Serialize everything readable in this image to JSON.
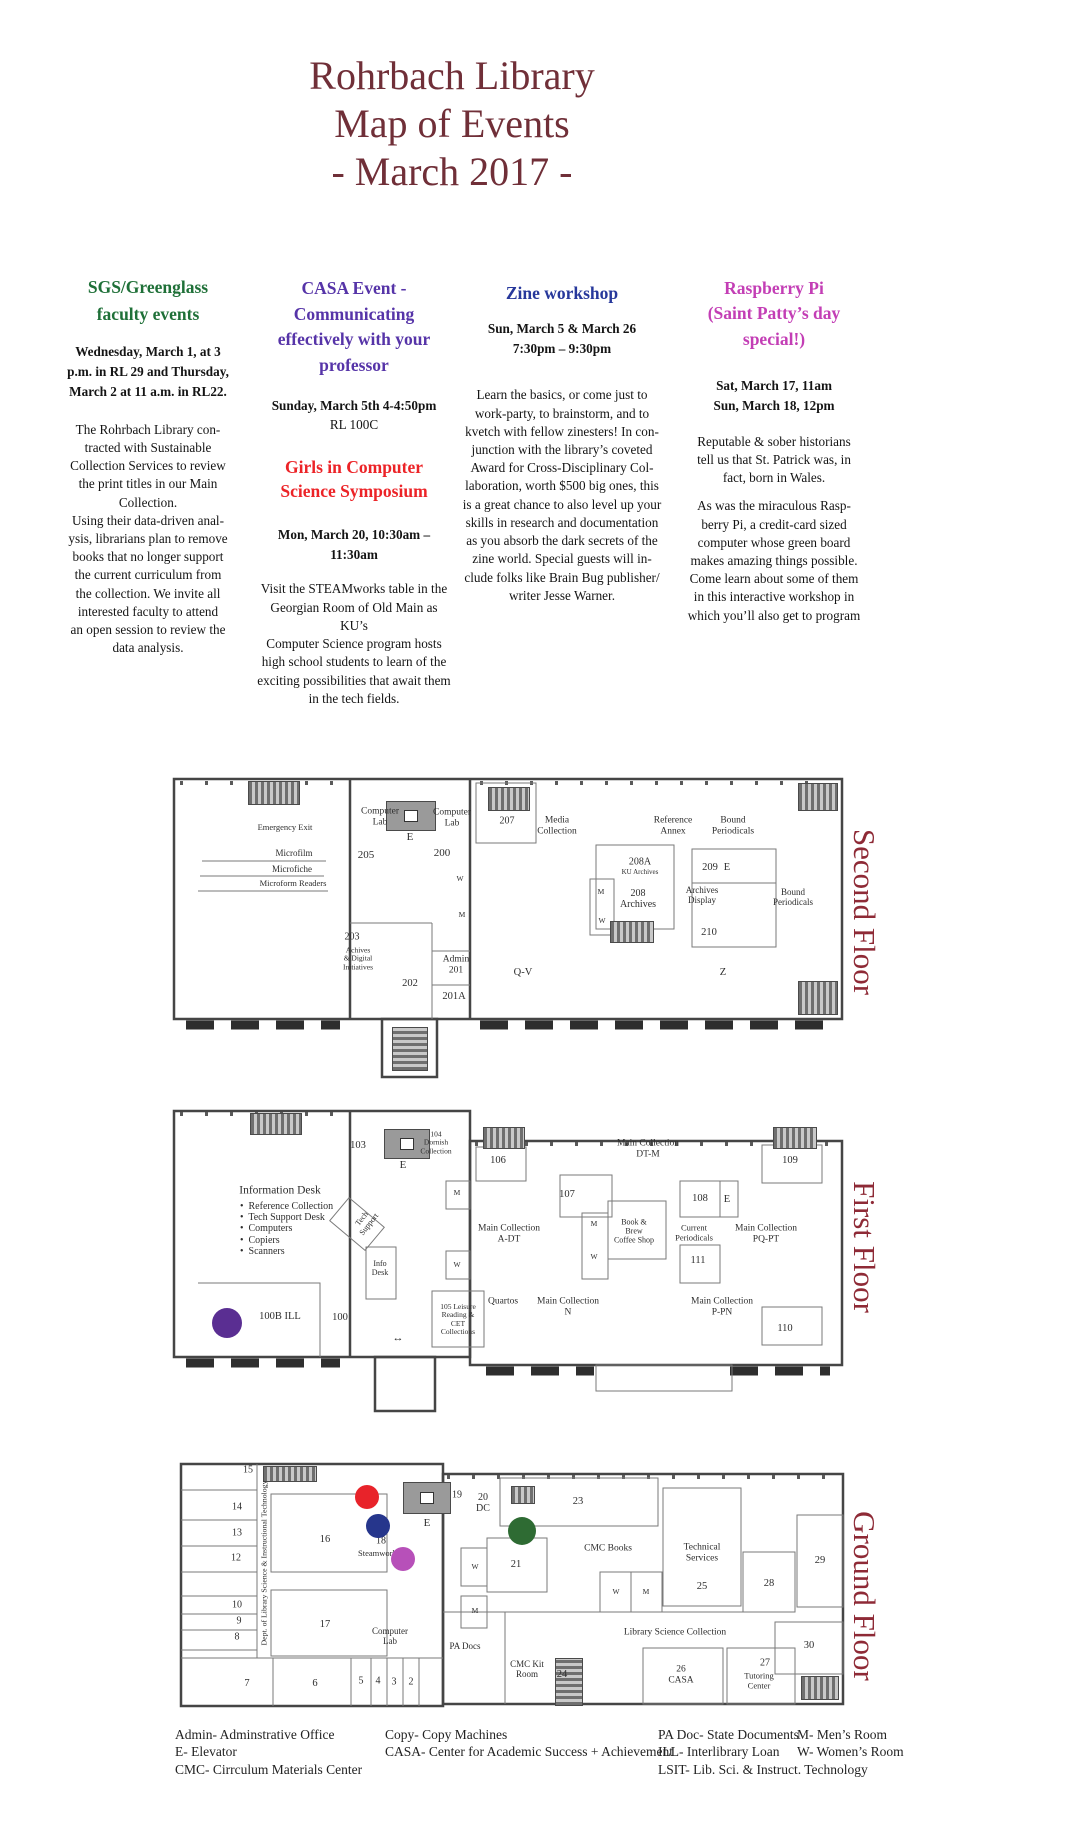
{
  "title_lines": [
    "Rohrbach Library",
    "Map of Events",
    "- March 2017 -"
  ],
  "colors": {
    "title_maroon": "#702f38",
    "floor_label_maroon": "#8e2a36",
    "sgs_green": "#1f7038",
    "casa_purple": "#5634a8",
    "girls_red": "#ec2327",
    "zine_blue": "#27389b",
    "raspberry_magenta": "#c33eb5",
    "marker_purple": "#5a2e92",
    "marker_red": "#e8232a",
    "marker_blue": "#26368c",
    "marker_orchid": "#b750b9",
    "marker_green": "#2e6b33"
  },
  "events": {
    "sgs": {
      "heading_lines": [
        "SGS/Greenglass",
        "faculty events"
      ],
      "when_lines": [
        "Wednesday, March 1, at 3",
        "p.m. in RL 29 and Thursday,",
        "March 2 at 11 a.m. in RL22."
      ],
      "body_lines": [
        "The Rohrbach Library con-",
        "tracted with Sustainable",
        "Collection Services to review",
        "the print titles in our Main",
        "Collection.",
        "Using their data-driven anal-",
        "ysis, librarians plan to remove",
        "books that no longer support",
        "the current curriculum from",
        "the collection. We invite all",
        "interested faculty to attend",
        "an open session to review the",
        "data analysis."
      ]
    },
    "casa": {
      "heading_lines": [
        "CASA Event -",
        "Communicating",
        "effectively with your",
        "professor"
      ],
      "when_bold": "Sunday, March 5th 4-4:50pm",
      "when_room": "RL 100C"
    },
    "girls": {
      "heading_lines": [
        "Girls in Computer",
        "Science Symposium"
      ],
      "when_lines": [
        "Mon, March 20, 10:30am –",
        "11:30am"
      ],
      "body_lines": [
        "Visit the STEAMworks table in the",
        "Georgian Room of Old Main as KU’s",
        "Computer Science program hosts",
        "high school students to learn of the",
        "exciting possibilities that await them",
        "in the tech fields."
      ]
    },
    "zine": {
      "heading": "Zine workshop",
      "when_lines": [
        "Sun, March 5 & March 26",
        "7:30pm – 9:30pm"
      ],
      "body_lines": [
        "Learn the basics, or come just to",
        "work-party, to brainstorm, and to",
        "kvetch with fellow zinesters! In con-",
        "junction with the library’s coveted",
        "Award for Cross-Disciplinary Col-",
        "laboration, worth $500 big ones, this",
        "is a great chance to also level up your",
        "skills in research and documentation",
        "as you absorb the dark secrets of the",
        "zine world. Special guests will in-",
        "clude folks like Brain Bug publisher/",
        "writer Jesse Warner."
      ]
    },
    "raspberry": {
      "heading_lines": [
        "Raspberry Pi",
        "(Saint Patty’s day",
        "special!)"
      ],
      "when_lines": [
        "Sat, March 17, 11am",
        "Sun, March 18, 12pm"
      ],
      "body1_lines": [
        "Reputable & sober historians",
        "tell us that St. Patrick was, in",
        "fact, born in Wales."
      ],
      "body2_lines": [
        "As was the miraculous Rasp-",
        "berry Pi, a credit-card sized",
        "computer whose green board",
        "makes amazing things possible.",
        "Come learn about some of them",
        "in this interactive workshop in",
        "which you’ll also get to program"
      ]
    }
  },
  "floors": [
    {
      "name": "Second Floor",
      "labels": [
        {
          "t": "Emergency Exit",
          "x": 115,
          "y": 53,
          "s": 8.5
        },
        {
          "t": "Microfilm",
          "x": 124,
          "y": 78,
          "s": 9
        },
        {
          "t": "Microfiche",
          "x": 122,
          "y": 94,
          "s": 9
        },
        {
          "t": "Microform Readers",
          "x": 123,
          "y": 109,
          "s": 8.5
        },
        {
          "t": "Computer\nLab",
          "x": 210,
          "y": 42,
          "s": 9.5
        },
        {
          "t": "205",
          "x": 196,
          "y": 80,
          "s": 11
        },
        {
          "t": "E",
          "x": 240,
          "y": 62,
          "s": 11
        },
        {
          "t": "Computer\nLab",
          "x": 282,
          "y": 43,
          "s": 9.5
        },
        {
          "t": "200",
          "x": 272,
          "y": 78,
          "s": 11
        },
        {
          "t": "W",
          "x": 290,
          "y": 104,
          "s": 7.5
        },
        {
          "t": "M",
          "x": 292,
          "y": 140,
          "s": 7.5
        },
        {
          "t": "207",
          "x": 337,
          "y": 46,
          "s": 10
        },
        {
          "t": "Media\nCollection",
          "x": 387,
          "y": 51,
          "s": 9.5
        },
        {
          "t": "Reference\nAnnex",
          "x": 503,
          "y": 51,
          "s": 9.5
        },
        {
          "t": "Bound\nPeriodicals",
          "x": 563,
          "y": 51,
          "s": 9.5
        },
        {
          "t": "208A",
          "x": 470,
          "y": 87,
          "s": 10
        },
        {
          "t": "KU Archives",
          "x": 470,
          "y": 98,
          "s": 7
        },
        {
          "t": "M",
          "x": 431,
          "y": 117,
          "s": 7.5
        },
        {
          "t": "208\nArchives",
          "x": 468,
          "y": 124,
          "s": 10
        },
        {
          "t": "209",
          "x": 540,
          "y": 93,
          "s": 10.5
        },
        {
          "t": "E",
          "x": 557,
          "y": 93,
          "s": 10.5
        },
        {
          "t": "Archives\nDisplay",
          "x": 532,
          "y": 120,
          "s": 9
        },
        {
          "t": "W",
          "x": 432,
          "y": 146,
          "s": 7.5
        },
        {
          "t": "210",
          "x": 539,
          "y": 158,
          "s": 10.5
        },
        {
          "t": "Bound\nPeriodicals",
          "x": 623,
          "y": 122,
          "s": 9
        },
        {
          "t": "203",
          "x": 182,
          "y": 162,
          "s": 10
        },
        {
          "t": "Achives\n& Digital\nInitiatives",
          "x": 188,
          "y": 184,
          "s": 7.5
        },
        {
          "t": "Admin\n201",
          "x": 286,
          "y": 190,
          "s": 9.5
        },
        {
          "t": "202",
          "x": 240,
          "y": 209,
          "s": 10.5
        },
        {
          "t": "201A",
          "x": 284,
          "y": 222,
          "s": 10.5
        },
        {
          "t": "Q-V",
          "x": 353,
          "y": 198,
          "s": 10.5
        },
        {
          "t": "Z",
          "x": 553,
          "y": 198,
          "s": 10.5
        }
      ],
      "markers": []
    },
    {
      "name": "First Floor",
      "labels": [
        {
          "t": "103",
          "x": 188,
          "y": 41,
          "s": 10.5
        },
        {
          "t": "E",
          "x": 233,
          "y": 60,
          "s": 11
        },
        {
          "t": "104\nDornish\nCollection",
          "x": 266,
          "y": 38,
          "s": 7.5
        },
        {
          "t": "Information Desk",
          "x": 110,
          "y": 86,
          "s": 11.5
        },
        {
          "t": "•  Reference Collection\n•  Tech Support Desk\n•  Computers\n•  Copiers\n•  Scanners",
          "x": 70,
          "y": 124,
          "s": 10,
          "a": "left"
        },
        {
          "t": "Tech\nSupport",
          "x": 196,
          "y": 117,
          "s": 8,
          "r": -52
        },
        {
          "t": "Info\nDesk",
          "x": 210,
          "y": 164,
          "s": 8
        },
        {
          "t": "M",
          "x": 287,
          "y": 88,
          "s": 7.5
        },
        {
          "t": "W",
          "x": 287,
          "y": 160,
          "s": 7.5
        },
        {
          "t": "100B ILL",
          "x": 110,
          "y": 212,
          "s": 10.5
        },
        {
          "t": "100",
          "x": 170,
          "y": 213,
          "s": 10.5
        },
        {
          "t": "↔",
          "x": 228,
          "y": 233,
          "s": 11
        },
        {
          "t": "105 Leisure\nReading &\nCET\nCollections",
          "x": 288,
          "y": 215,
          "s": 7.5
        },
        {
          "t": "106",
          "x": 328,
          "y": 56,
          "s": 10.5
        },
        {
          "t": "Main Collection\nDT-M",
          "x": 478,
          "y": 44,
          "s": 9.5
        },
        {
          "t": "107",
          "x": 397,
          "y": 90,
          "s": 10.5
        },
        {
          "t": "M",
          "x": 424,
          "y": 119,
          "s": 7.5
        },
        {
          "t": "W",
          "x": 424,
          "y": 152,
          "s": 7.5
        },
        {
          "t": "Book &\nBrew\nCoffee Shop",
          "x": 464,
          "y": 127,
          "s": 8
        },
        {
          "t": "108",
          "x": 530,
          "y": 94,
          "s": 10.5
        },
        {
          "t": "E",
          "x": 557,
          "y": 95,
          "s": 10.5
        },
        {
          "t": "Current\nPeriodicals",
          "x": 524,
          "y": 128,
          "s": 8.5
        },
        {
          "t": "111",
          "x": 528,
          "y": 156,
          "s": 10.5
        },
        {
          "t": "Main Collection\nA-DT",
          "x": 339,
          "y": 129,
          "s": 9.5
        },
        {
          "t": "Main Collection\nPQ-PT",
          "x": 596,
          "y": 129,
          "s": 9.5
        },
        {
          "t": "Quartos",
          "x": 333,
          "y": 197,
          "s": 9.5
        },
        {
          "t": "Main Collection\nN",
          "x": 398,
          "y": 202,
          "s": 9.5
        },
        {
          "t": "Main Collection\nP-PN",
          "x": 552,
          "y": 202,
          "s": 9.5
        },
        {
          "t": "109",
          "x": 620,
          "y": 56,
          "s": 10.5
        },
        {
          "t": "110",
          "x": 615,
          "y": 224,
          "s": 10.5
        }
      ],
      "markers": [
        {
          "c": "#5a2e92",
          "x": 57,
          "y": 218,
          "r": 15
        }
      ]
    },
    {
      "name": "Ground Floor",
      "labels": [
        {
          "t": "15",
          "x": 73,
          "y": 10,
          "s": 10
        },
        {
          "t": "14",
          "x": 62,
          "y": 47,
          "s": 10
        },
        {
          "t": "13",
          "x": 62,
          "y": 73,
          "s": 10
        },
        {
          "t": "12",
          "x": 61,
          "y": 98,
          "s": 10
        },
        {
          "t": "16",
          "x": 150,
          "y": 80,
          "s": 10.5
        },
        {
          "t": "10",
          "x": 62,
          "y": 145,
          "s": 10
        },
        {
          "t": "9",
          "x": 64,
          "y": 161,
          "s": 10
        },
        {
          "t": "8",
          "x": 62,
          "y": 177,
          "s": 10
        },
        {
          "t": "17",
          "x": 150,
          "y": 165,
          "s": 10.5
        },
        {
          "t": "7",
          "x": 72,
          "y": 224,
          "s": 10.5
        },
        {
          "t": "6",
          "x": 140,
          "y": 224,
          "s": 10.5
        },
        {
          "t": "5",
          "x": 186,
          "y": 221,
          "s": 10
        },
        {
          "t": "4",
          "x": 203,
          "y": 221,
          "s": 10
        },
        {
          "t": "3",
          "x": 219,
          "y": 222,
          "s": 10
        },
        {
          "t": "2",
          "x": 236,
          "y": 222,
          "s": 10
        },
        {
          "t": "Dept. of Library Science & Instructional Technology",
          "x": 90,
          "y": 103,
          "s": 7.8,
          "r": -90
        },
        {
          "t": "18",
          "x": 206,
          "y": 81,
          "s": 10
        },
        {
          "t": "Steamworks",
          "x": 204,
          "y": 94,
          "s": 8.5
        },
        {
          "t": "E",
          "x": 252,
          "y": 63,
          "s": 11
        },
        {
          "t": "19",
          "x": 282,
          "y": 35,
          "s": 10
        },
        {
          "t": "20\nDC",
          "x": 308,
          "y": 43,
          "s": 10
        },
        {
          "t": "23",
          "x": 403,
          "y": 42,
          "s": 10.5
        },
        {
          "t": "21",
          "x": 341,
          "y": 105,
          "s": 10.5
        },
        {
          "t": "W",
          "x": 300,
          "y": 107,
          "s": 7.5
        },
        {
          "t": "M",
          "x": 300,
          "y": 151,
          "s": 7.5
        },
        {
          "t": "CMC Books",
          "x": 433,
          "y": 89,
          "s": 9.5
        },
        {
          "t": "Technical\nServices",
          "x": 527,
          "y": 93,
          "s": 9.5
        },
        {
          "t": "25",
          "x": 527,
          "y": 127,
          "s": 10.5
        },
        {
          "t": "W",
          "x": 441,
          "y": 132,
          "s": 7.5
        },
        {
          "t": "M",
          "x": 471,
          "y": 132,
          "s": 7.5
        },
        {
          "t": "28",
          "x": 594,
          "y": 124,
          "s": 10.5
        },
        {
          "t": "29",
          "x": 645,
          "y": 101,
          "s": 10.5
        },
        {
          "t": "Library Science Collection",
          "x": 500,
          "y": 173,
          "s": 9.5
        },
        {
          "t": "Computer\nLab",
          "x": 215,
          "y": 176,
          "s": 9
        },
        {
          "t": "PA Docs",
          "x": 290,
          "y": 186,
          "s": 9
        },
        {
          "t": "CMC Kit\nRoom",
          "x": 352,
          "y": 209,
          "s": 9
        },
        {
          "t": "24",
          "x": 387,
          "y": 215,
          "s": 10.5
        },
        {
          "t": "26\nCASA",
          "x": 506,
          "y": 215,
          "s": 9.5
        },
        {
          "t": "27",
          "x": 590,
          "y": 203,
          "s": 10
        },
        {
          "t": "Tutoring\nCenter",
          "x": 584,
          "y": 221,
          "s": 8.5
        },
        {
          "t": "30",
          "x": 634,
          "y": 186,
          "s": 10.5
        }
      ],
      "markers": [
        {
          "c": "#e8232a",
          "x": 192,
          "y": 37,
          "r": 12
        },
        {
          "c": "#26368c",
          "x": 203,
          "y": 66,
          "r": 12
        },
        {
          "c": "#b750b9",
          "x": 228,
          "y": 99,
          "r": 12
        },
        {
          "c": "#2e6b33",
          "x": 347,
          "y": 71,
          "r": 14
        }
      ]
    }
  ],
  "legend": {
    "col1": [
      "Admin- Adminstrative Office",
      "E- Elevator",
      "CMC- Cirrculum Materials Center"
    ],
    "col2": [
      "Copy- Copy Machines",
      "CASA- Center for Academic Success + Achievement"
    ],
    "col3": [
      "PA Doc- State Documents",
      "ILL- Interlibrary Loan",
      "LSIT- Lib. Sci. & Instruct. Technology"
    ],
    "col4": [
      "M- Men’s Room",
      "W- Women’s Room"
    ]
  }
}
